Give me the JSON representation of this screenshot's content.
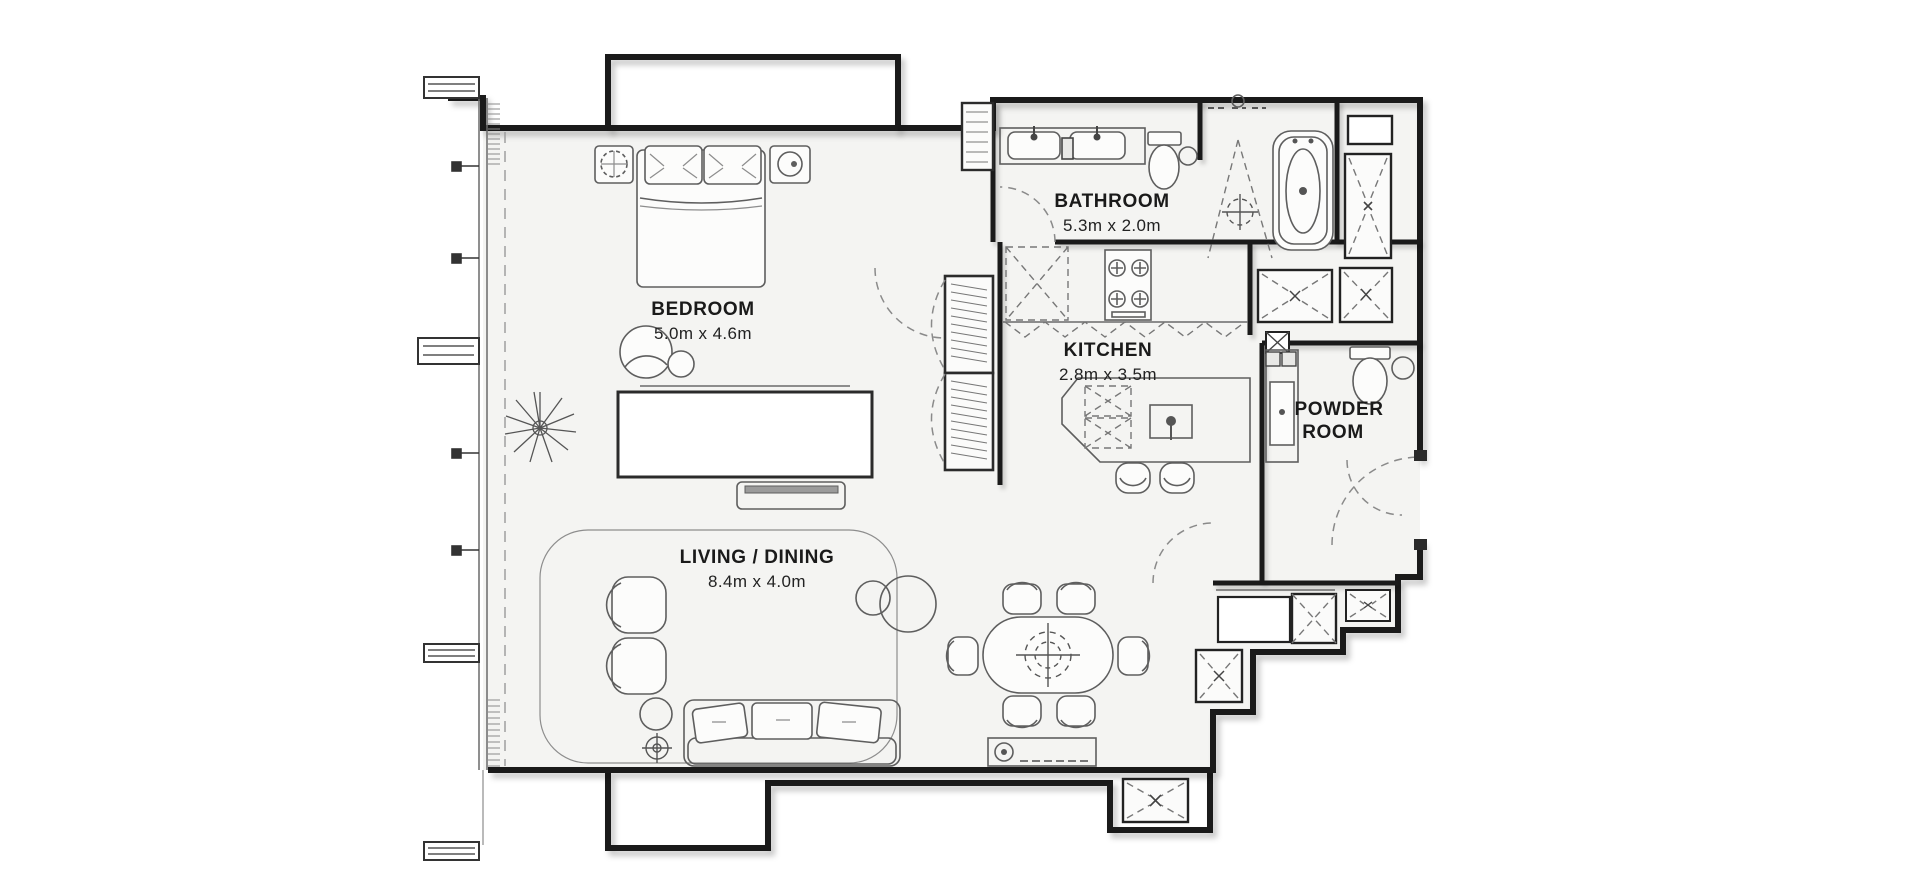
{
  "rooms": {
    "bedroom": {
      "label": "BEDROOM",
      "dims": "5.0m x 4.6m"
    },
    "bathroom": {
      "label": "BATHROOM",
      "dims": "5.3m x 2.0m"
    },
    "kitchen": {
      "label": "KITCHEN",
      "dims": "2.8m x 3.5m"
    },
    "living_dining": {
      "label": "LIVING / DINING",
      "dims": "8.4m x 4.0m"
    },
    "powder_room": {
      "label_line1": "POWDER",
      "label_line2": "ROOM"
    }
  },
  "colors": {
    "wall": "#1a1a1a",
    "floor": "#f4f4f2",
    "background": "#ffffff",
    "furniture_line": "#5e5e5e",
    "text": "#1a1a1a"
  }
}
